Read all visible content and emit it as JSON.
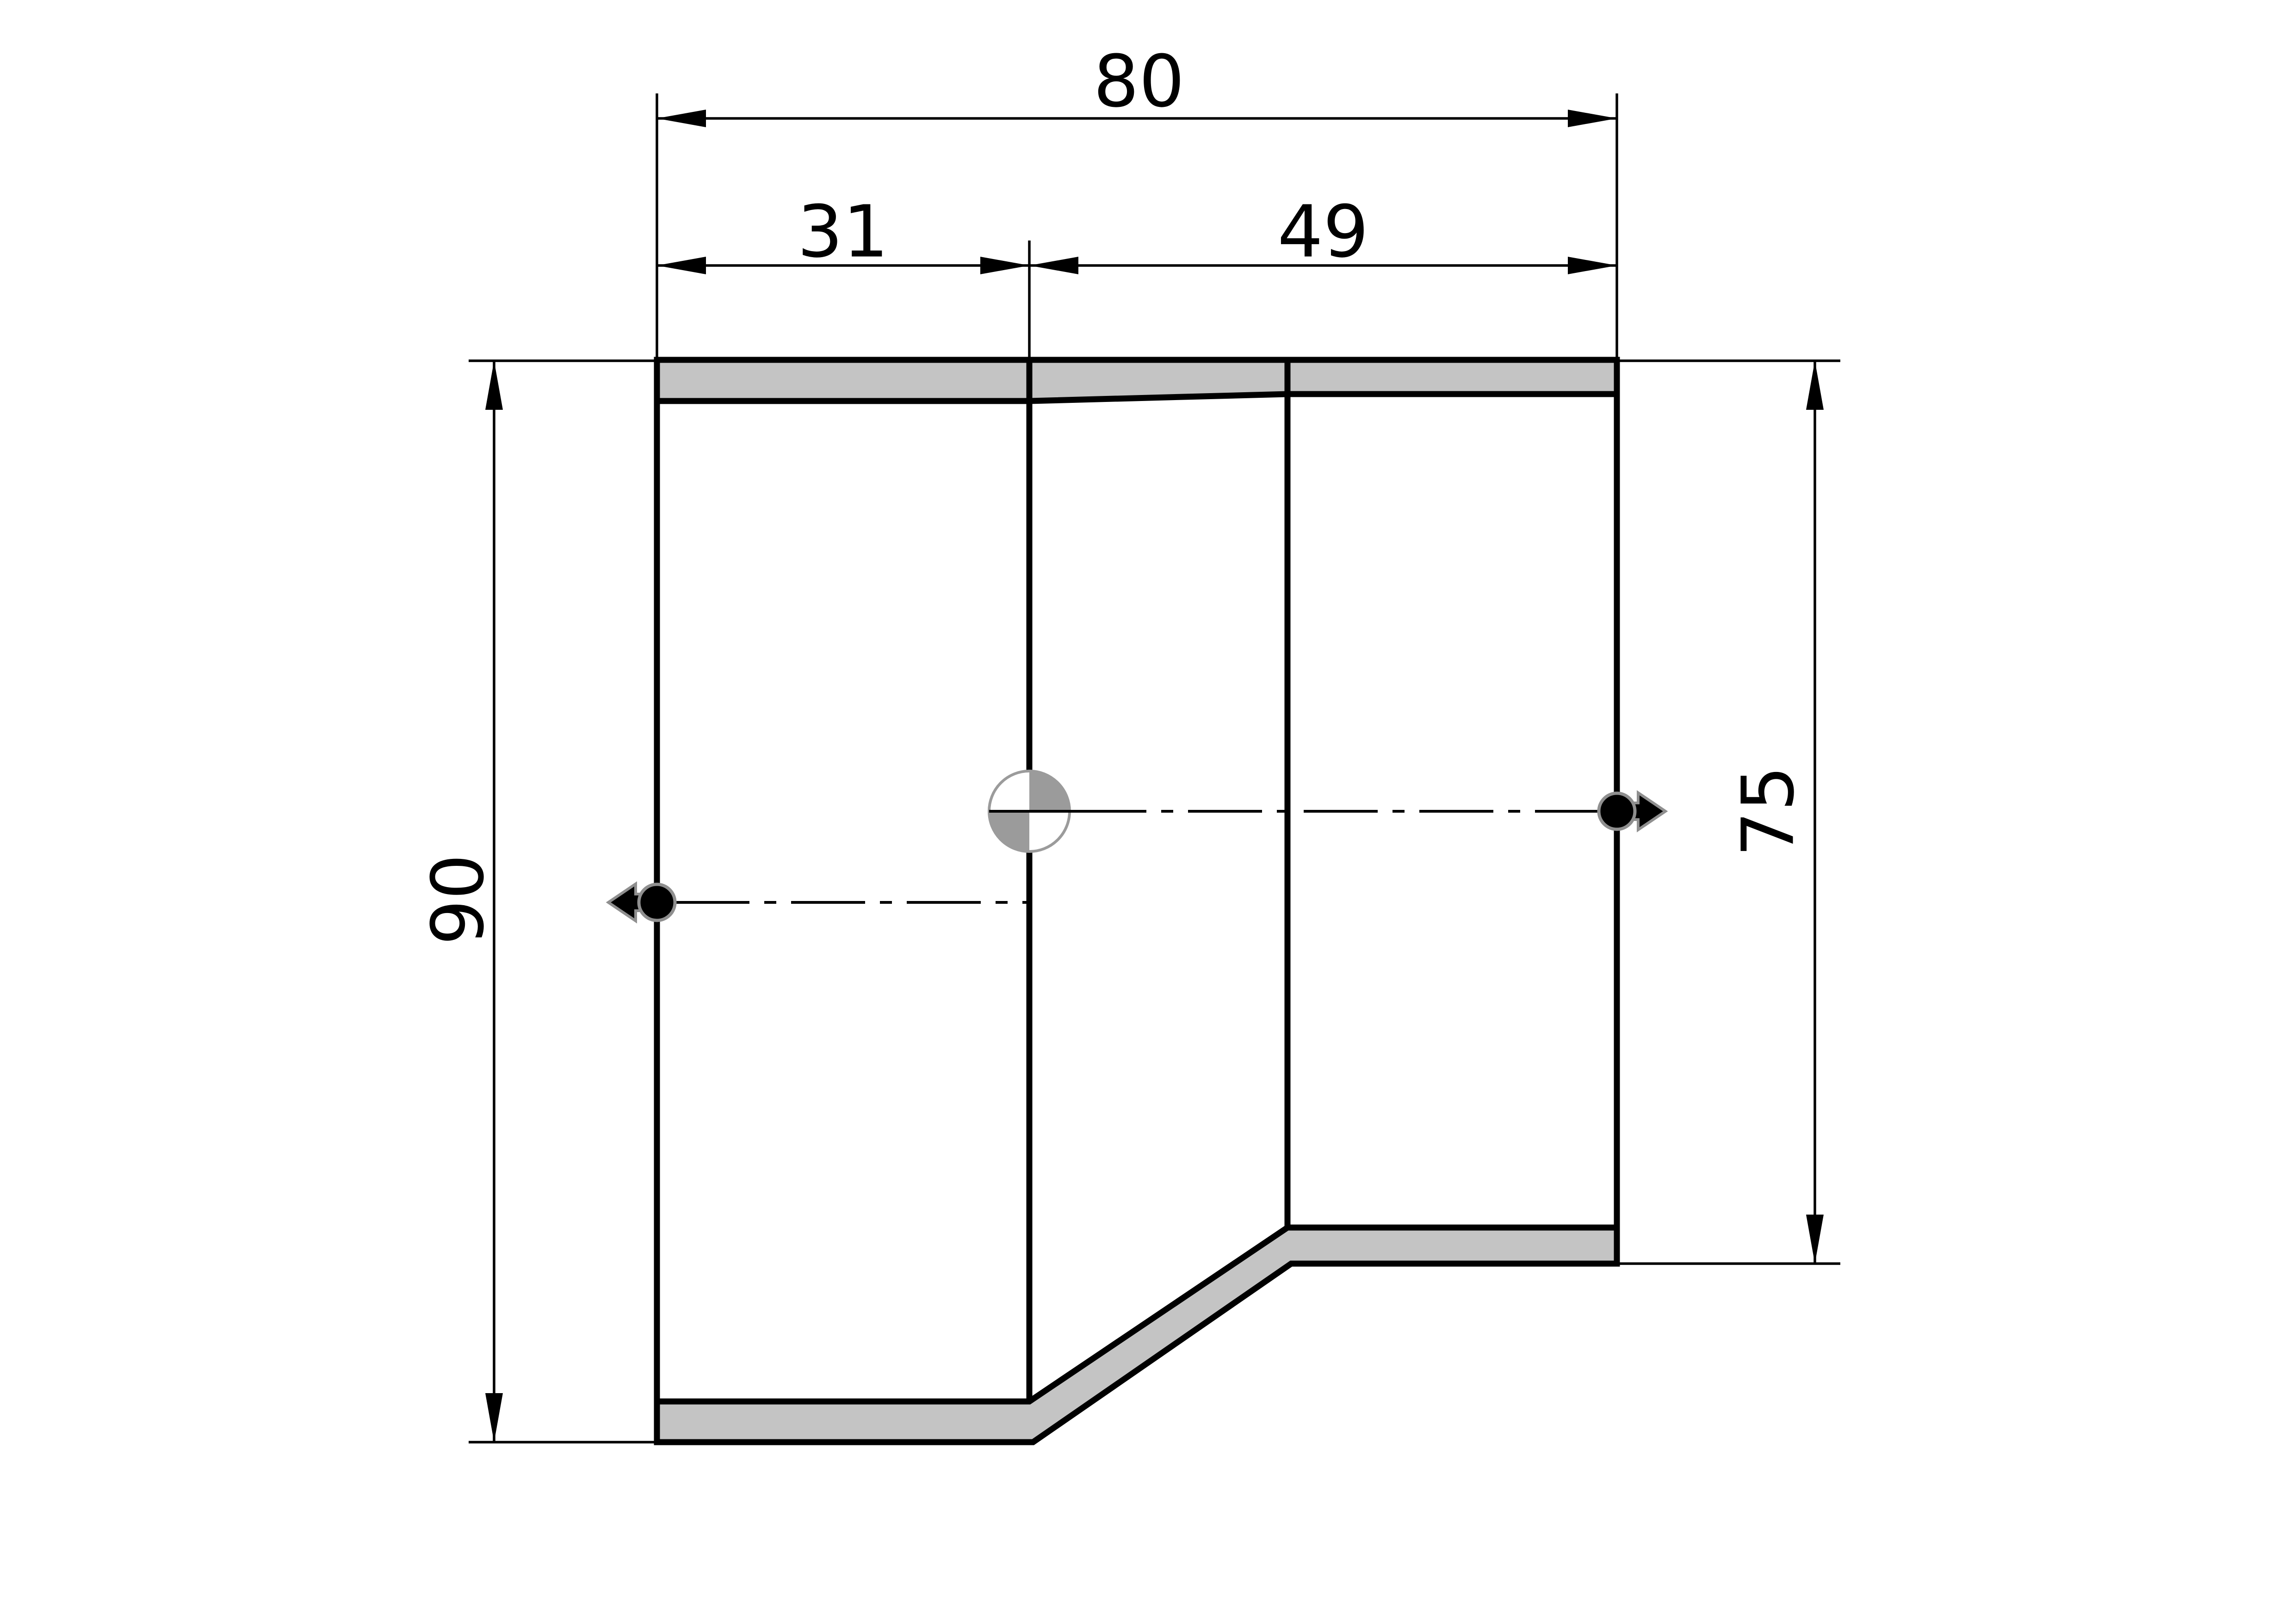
{
  "page": {
    "background": "#ffffff"
  },
  "drawing": {
    "kind": "technical-section-drawing-of-eccentric-pipe-reducer",
    "style": {
      "wall_fill": "#c4c4c4",
      "quadrant_fill": "#9b9b9b",
      "marker_outline": "#8f8f8f",
      "symbol_stroke": "#9b9b9b",
      "line_color": "#000000"
    }
  },
  "dimensions": {
    "overall_length": {
      "label": "80"
    },
    "large_end_length": {
      "label": "31"
    },
    "small_end_length": {
      "label": "49"
    },
    "large_end_diameter": {
      "label": "90"
    },
    "small_end_diameter": {
      "label": "75"
    }
  }
}
